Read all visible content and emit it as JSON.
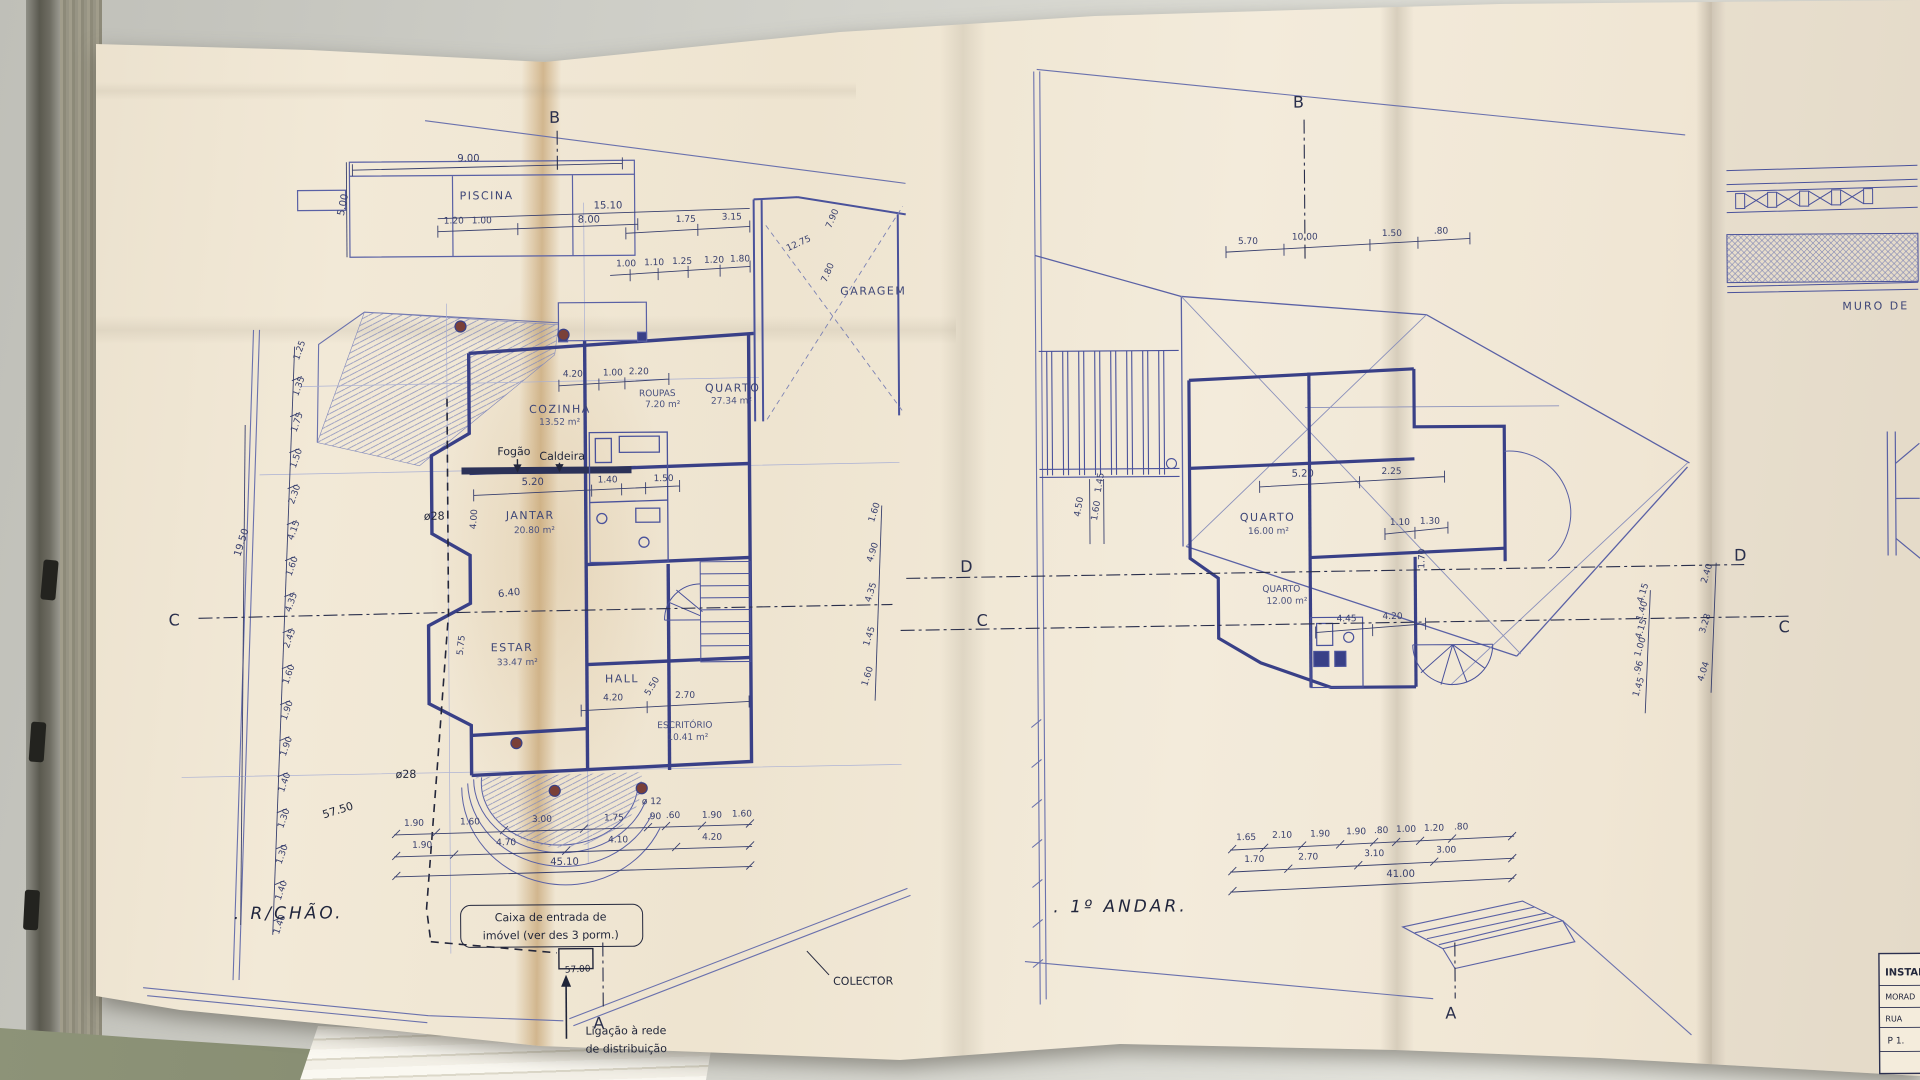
{
  "lp": {
    "title": ". R/CHÃO.",
    "pool": "PISCINA",
    "garage": "GARAGEM",
    "rooms": {
      "cozinha": "COZINHA",
      "cozinha_a": "13.52 m²",
      "jantar": "JANTAR",
      "jantar_a": "20.80 m²",
      "estar": "ESTAR",
      "estar_a": "33.47 m²",
      "hall": "HALL",
      "escritorio": "ESCRITÓRIO",
      "escritorio_a": "10.41 m²",
      "roupas": "ROUPAS",
      "roupas_a": "7.20 m²",
      "quarto": "QUARTO",
      "quarto_a": "27.34 m²"
    },
    "ann": {
      "fogao": "Fogão",
      "caldeira": "Caldeira",
      "o28": "ø28",
      "o12": "ø 12",
      "caixa1": "Caixa de entrada de",
      "caixa2": "imóvel (ver des 3 porm.)",
      "lig1": "Ligação à rede",
      "lig2": "de distribuição",
      "colector": "COLECTOR",
      "d575": "57.50",
      "d570": "57.00",
      "total_b": "45.10",
      "total_v": "19.50"
    },
    "pool_dims": {
      "w": "9.00",
      "h": "5.00",
      "a": "1.20",
      "b": "1.00",
      "c": "8.00",
      "d": "15.10"
    },
    "top_dims": [
      "1.75",
      "3.15",
      "1.00",
      "1.10",
      "1.25",
      "1.20",
      "1.80"
    ],
    "diag": [
      "12.75",
      "7.90",
      "7.80"
    ],
    "mid": [
      "4.20",
      "1.00",
      "2.20",
      "5.20",
      "1.40",
      "1.50",
      "4.00",
      "6.40",
      "5.75",
      "5.50",
      "4.20",
      "2.70"
    ],
    "brow1": [
      "1.90",
      "1.60",
      "3.00",
      "1.75",
      ".90",
      ".60",
      "1.90",
      "1.60"
    ],
    "brow2": [
      "1.90",
      "4.70",
      "4.10",
      "4.20"
    ],
    "vchain": [
      "1.25",
      "1.35",
      "1.75",
      "1.50",
      "2.30",
      "4.15",
      "1.60",
      "4.35",
      "2.45",
      "1.60",
      "1.90",
      "1.90",
      "1.40",
      "1.30",
      "1.30",
      "1.40",
      "1.40"
    ]
  },
  "rp": {
    "title": ". 1º ANDAR.",
    "quarto1": "QUARTO",
    "quarto1_a": "16.00 m²",
    "quarto2": "QUARTO",
    "quarto2_a": "12.00 m²",
    "top": [
      "5.70",
      "10.00",
      "1.50",
      ".80"
    ],
    "mid": [
      "5.20",
      "2.25",
      "1.10",
      "1.30",
      "1.70",
      "4.45",
      "4.20",
      "4.50",
      "1.60",
      "1.45"
    ],
    "lchain": [
      "1.60",
      "4.90",
      "4.35",
      "1.45",
      "1.60"
    ],
    "rchain": [
      "4.15",
      "1.40",
      "4.15",
      "1.00",
      ".96",
      "1.45"
    ],
    "rchain2": [
      "2.40",
      "3.28",
      "4.04"
    ],
    "brow1": [
      "1.65",
      "2.10",
      "1.90",
      "1.90",
      ".80",
      "1.00",
      "1.20",
      ".80"
    ],
    "brow2": [
      "1.70",
      "2.70",
      "3.10",
      "3.00"
    ],
    "total_b": "41.00"
  },
  "letters": {
    "a": "A",
    "b": "B",
    "c": "C",
    "d": "D"
  },
  "side": {
    "muro": "MURO DE",
    "tb_header": "INSTAL",
    "tb_row1": "MORAD",
    "tb_row2": "RUA",
    "tb_row3": "P 1."
  },
  "colors": {
    "ink": "#4a529b",
    "ink_heavy": "#394087",
    "ink_dark": "#262b44",
    "paper": "#f1e8d6",
    "fold": "#d4b88c",
    "desk": "#d0d0c9"
  }
}
